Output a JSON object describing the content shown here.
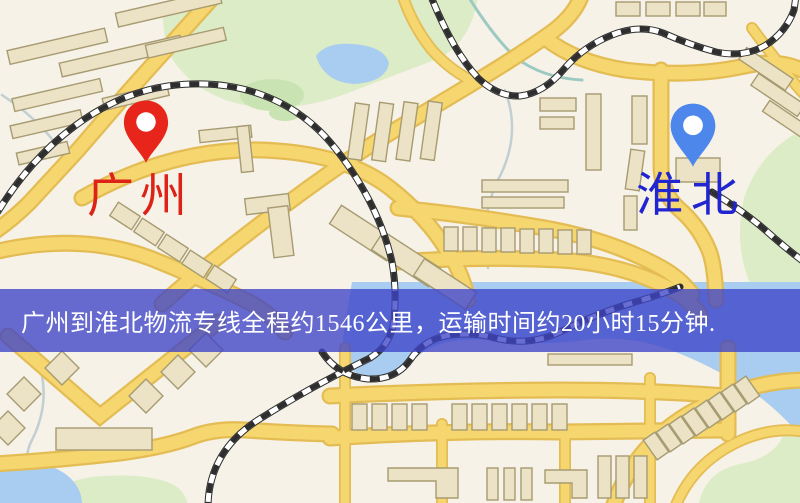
{
  "banner": {
    "text": "广州到淮北物流专线全程约1546公里，运输时间约20小时15分钟.",
    "background": "rgba(62,68,200,0.78)",
    "text_color": "#ffffff"
  },
  "markers": {
    "origin": {
      "label": "广州",
      "pin_color": "#e8251b",
      "label_color": "#dd2217"
    },
    "destination": {
      "label": "淮北",
      "pin_color": "#4e87ec",
      "label_color": "#2025cf"
    }
  },
  "map_colors": {
    "background": "#f6f2e7",
    "road": "#f6d66e",
    "road_casing": "#e4bc54",
    "water": "#a9cdf0",
    "park": "#dcecc6",
    "park_dark": "#c9e3b2",
    "building": "#ece3c6",
    "building_outline": "#a79b72"
  }
}
